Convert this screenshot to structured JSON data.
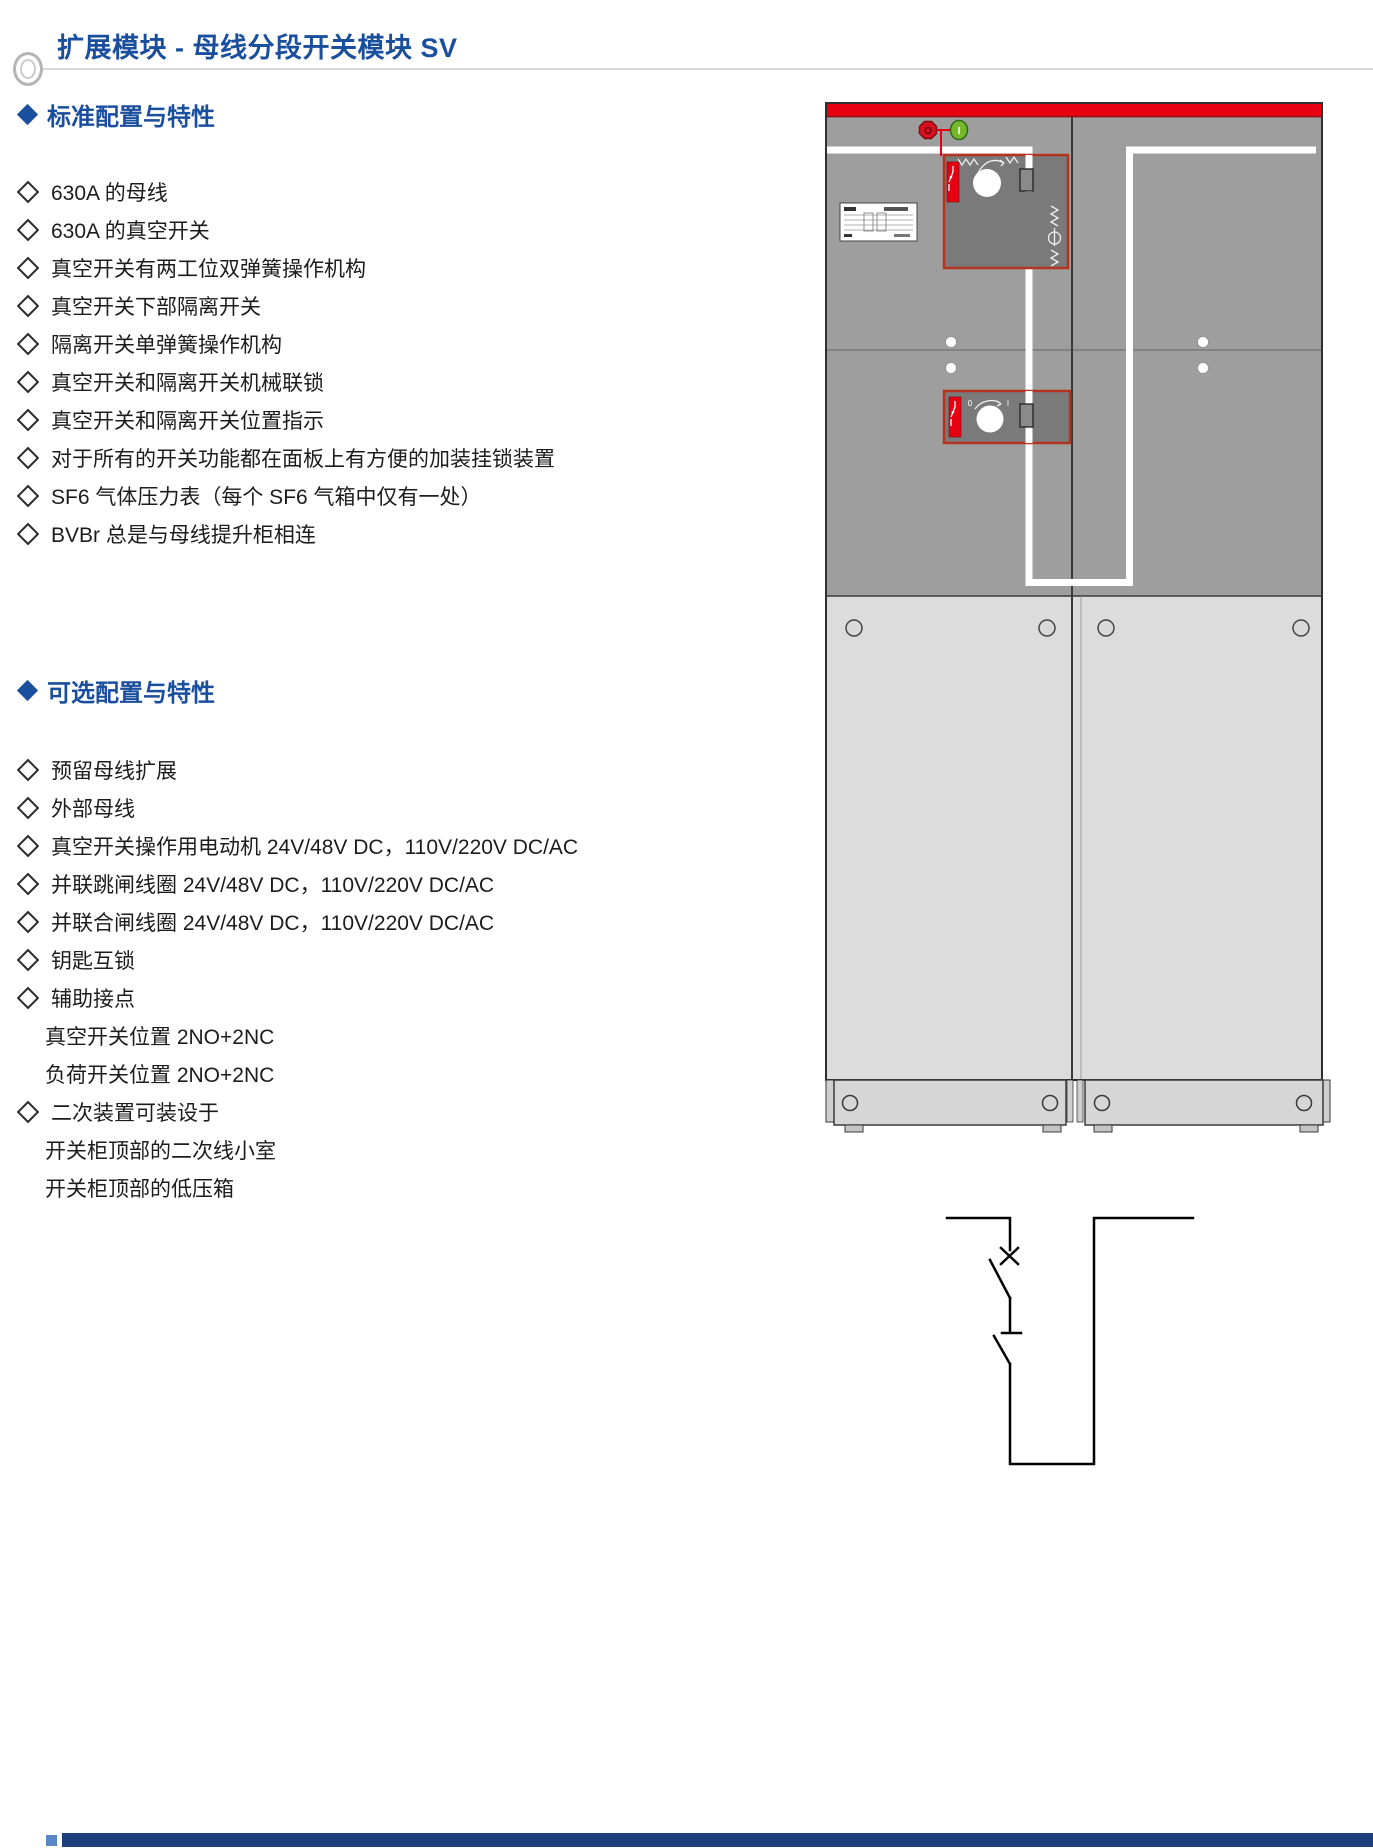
{
  "page": {
    "title": "扩展模块 - 母线分段开关模块 SV"
  },
  "sections": [
    {
      "heading": "标准配置与特性",
      "items": [
        {
          "text": "630A 的母线",
          "indent": false
        },
        {
          "text": "630A 的真空开关",
          "indent": false
        },
        {
          "text": "真空开关有两工位双弹簧操作机构",
          "indent": false
        },
        {
          "text": "真空开关下部隔离开关",
          "indent": false
        },
        {
          "text": "隔离开关单弹簧操作机构",
          "indent": false
        },
        {
          "text": "真空开关和隔离开关机械联锁",
          "indent": false
        },
        {
          "text": "真空开关和隔离开关位置指示",
          "indent": false
        },
        {
          "text": "对于所有的开关功能都在面板上有方便的加装挂锁装置",
          "indent": false
        },
        {
          "text": "SF6 气体压力表（每个 SF6 气箱中仅有一处）",
          "indent": false
        },
        {
          "text": "BVBr 总是与母线提升柜相连",
          "indent": false
        }
      ]
    },
    {
      "heading": "可选配置与特性",
      "items": [
        {
          "text": "预留母线扩展",
          "indent": false
        },
        {
          "text": "外部母线",
          "indent": false
        },
        {
          "text": "真空开关操作用电动机 24V/48V DC，110V/220V DC/AC",
          "indent": false
        },
        {
          "text": "并联跳闸线圈 24V/48V DC，110V/220V DC/AC",
          "indent": false
        },
        {
          "text": "并联合闸线圈 24V/48V DC，110V/220V DC/AC",
          "indent": false
        },
        {
          "text": "钥匙互锁",
          "indent": false
        },
        {
          "text": "辅助接点",
          "indent": false
        },
        {
          "text": "真空开关位置 2NO+2NC",
          "indent": true
        },
        {
          "text": "负荷开关位置 2NO+2NC",
          "indent": true
        },
        {
          "text": "二次装置可装设于",
          "indent": false
        },
        {
          "text": "开关柜顶部的二次线小室",
          "indent": true
        },
        {
          "text": "开关柜顶部的低压箱",
          "indent": true
        }
      ]
    }
  ],
  "figure": {
    "stop_button_label": "O",
    "start_button_label": "I",
    "isolator_dial_min": "0",
    "isolator_dial_max": "I",
    "colors": {
      "accent_blue": "#1a4f9e",
      "cabinet_red": "#e60012",
      "mech_border_red": "#b43420",
      "start_green": "#76b82a",
      "cabinet_gray": "#9e9e9e",
      "door_gray": "#dcdcdc",
      "mech_gray": "#7a7a7a",
      "footer_navy": "#1d3e7c"
    }
  }
}
